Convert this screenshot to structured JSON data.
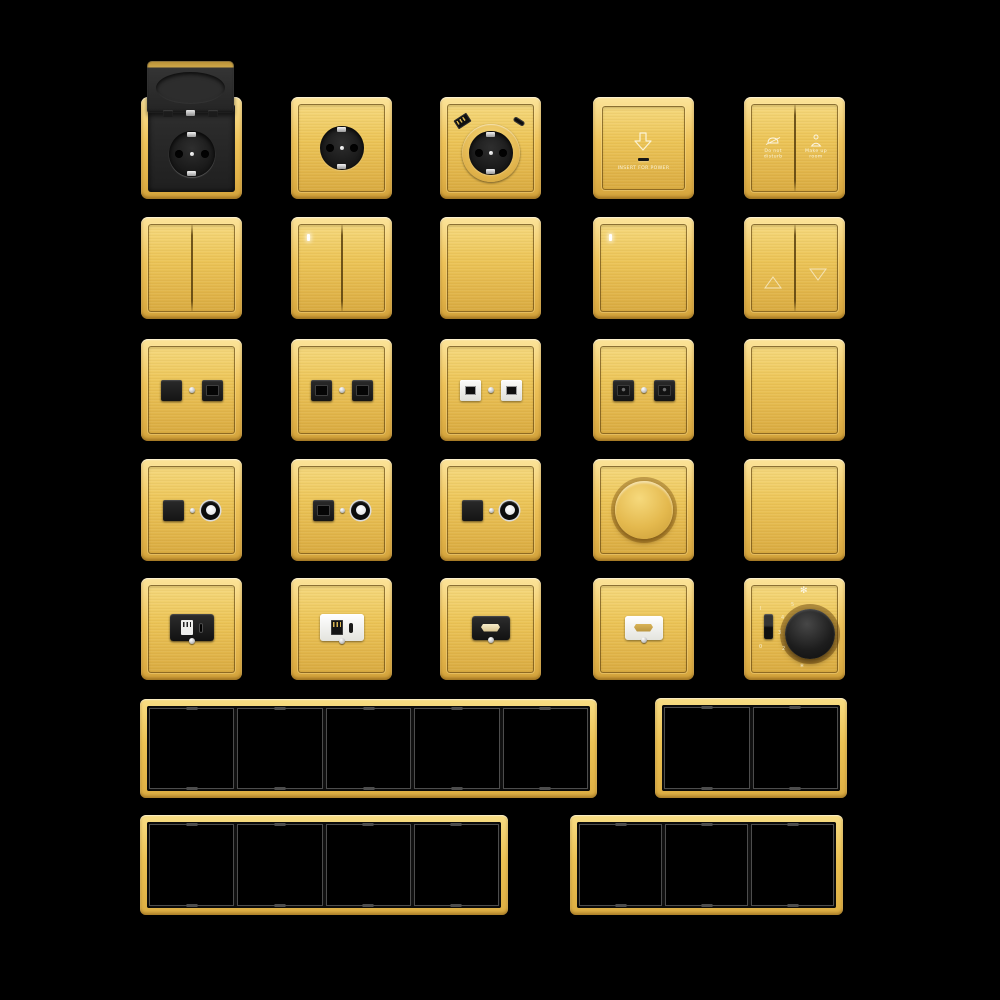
{
  "scene": {
    "description": "Brushed gold wall switch and socket collection on black background",
    "background_color": "#000000"
  },
  "colors": {
    "gold": "#ECC558",
    "gold_light": "#F8DD84",
    "gold_dark": "#D4A43C",
    "module_black": "#1E1E1E",
    "module_white": "#F2F2F0",
    "metal_silver": "#DCDCDC",
    "indicator_white": "#FFFFFF"
  },
  "catalog": {
    "row1": [
      "socket-with-flip-cover",
      "schuko-socket",
      "schuko-socket-usb",
      "card-power-switch",
      "hotel-service-switch"
    ],
    "row2": [
      "switch-2gang",
      "switch-2gang-led",
      "switch-1gang",
      "switch-1gang-led",
      "curtain-switch"
    ],
    "row3": [
      "tv-data-socket",
      "data-socket-double",
      "data-socket-double-white",
      "phone-socket-double",
      "blank-plate"
    ],
    "row4": [
      "tv-data-coax-socket",
      "data-coax-socket",
      "tv-coax-socket",
      "rotary-dimmer",
      "blank-plate"
    ],
    "row5": [
      "usb-charger-black",
      "usb-charger-white",
      "hdmi-socket-black",
      "hdmi-socket-white",
      "fan-speed-controller"
    ],
    "frames": [
      {
        "gangs": 5
      },
      {
        "gangs": 2
      },
      {
        "gangs": 4
      },
      {
        "gangs": 3
      }
    ]
  },
  "icons": {
    "arrow_down": "block-arrow-down-outline",
    "do_not_disturb": "bell-with-slash",
    "make_up_room": "housekeeper",
    "curtain_up": "triangle-up-outline",
    "curtain_down": "triangle-down-outline",
    "fan": "✻"
  },
  "texts": {
    "card_switch_label": "INSERT FOR POWER",
    "dnd_line1": "Do not",
    "dnd_line2": "disturb",
    "mur_line1": "Make up",
    "mur_line2": "room",
    "fan_on": "I",
    "fan_off": "0",
    "fan_glyph": "✻",
    "fan_mark_glyph": "✻"
  },
  "fan_dial_marks": [
    "5",
    "4",
    "3",
    "2"
  ]
}
